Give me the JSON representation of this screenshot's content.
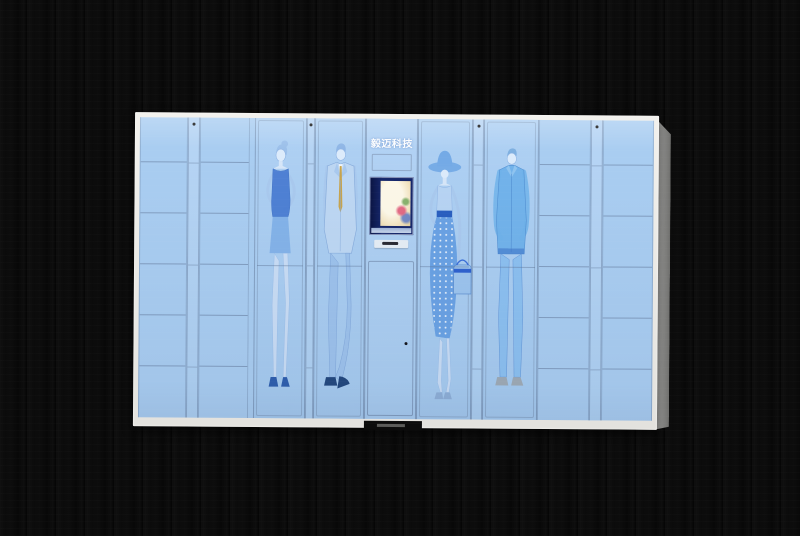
{
  "scene": {
    "backdrop": "dark wood plank wall",
    "backdrop_color": "#0b0b0b"
  },
  "cabinet": {
    "brand_label": "毅迈科技",
    "front_color": "#a9cdf1",
    "frame_color": "#eceae6",
    "side_color": "#8e8e8c",
    "small_locker_columns": 4,
    "rows_per_small_column": 6,
    "large_doors": 4,
    "artwork_figures": [
      "woman-dress",
      "man-suit",
      "woman-hat",
      "man-casual"
    ],
    "artwork_ink_color": "#5d8fd4",
    "console": {
      "screen_bezel_color": "#16276b",
      "screen_glow_color": "#f7eed6",
      "slot_color": "#e6edf5",
      "lock_color": "#15151a"
    }
  }
}
